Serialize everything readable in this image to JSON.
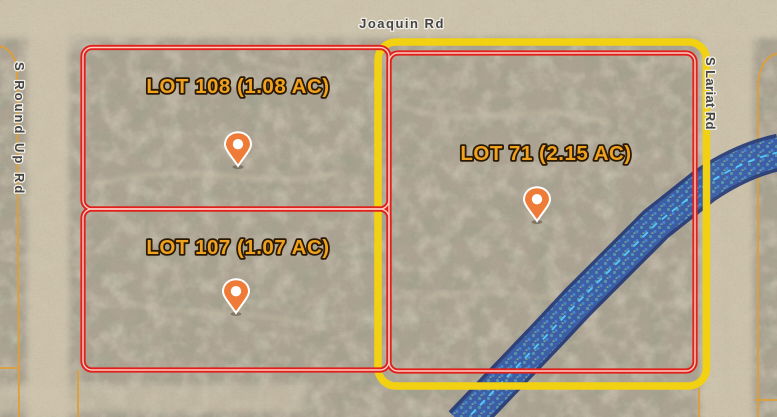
{
  "map": {
    "type": "satellite-parcel-view",
    "roads": [
      {
        "name": "Joaquin Rd",
        "orientation": "horizontal"
      },
      {
        "name": "S Round Up Rd",
        "orientation": "vertical"
      },
      {
        "name": "S Lariat Rd",
        "orientation": "vertical"
      }
    ],
    "lots": [
      {
        "id": "108",
        "label": "LOT 108 (1.08 AC)",
        "acres": "1.08",
        "outline": "red",
        "pin": true
      },
      {
        "id": "107",
        "label": "LOT 107 (1.07 AC)",
        "acres": "1.07",
        "outline": "red",
        "pin": true
      },
      {
        "id": "71",
        "label": "LOT 71 (2.15 AC)",
        "acres": "2.15",
        "outline": "red",
        "highlight": "yellow",
        "pin": true
      }
    ],
    "overlays": [
      {
        "name": "flood-zone-wash",
        "style": "blue-hatched-band-with-dashed-centerline"
      }
    ],
    "colors": {
      "parcel_highlight_red": "#e0201a",
      "parcel_highlight_inner": "#ffcfc6",
      "selection_yellow": "#f2d113",
      "parcel_line_orange": "#df9f35",
      "flood_zone_border": "#122c73",
      "flood_zone_fill": "#4a78d0",
      "flood_centerline": "#55d0ff",
      "marker_orange": "#ee7c38",
      "lot_label_gold": "#f0a11d",
      "terrain_base": "#ada393",
      "road_sand": "#cfc5ae"
    }
  }
}
